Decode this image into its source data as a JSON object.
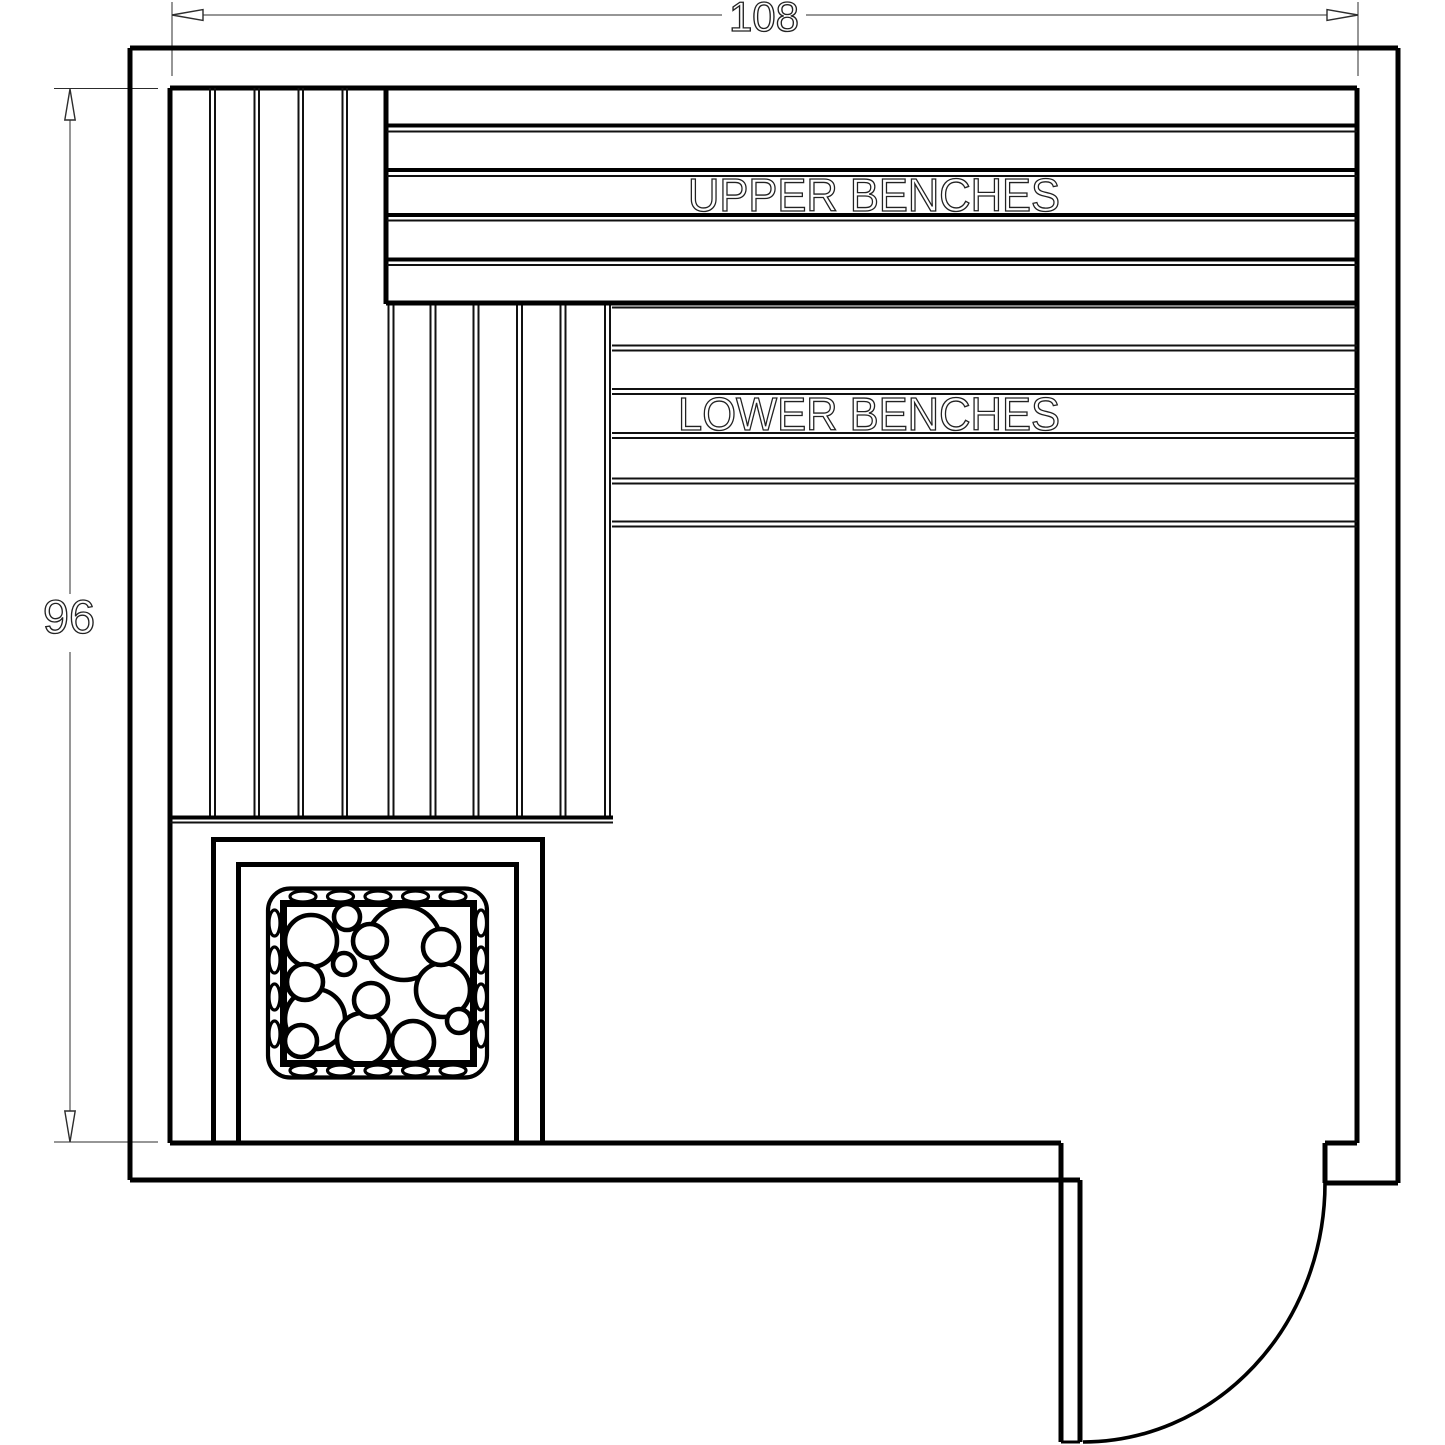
{
  "drawing": {
    "background": "#ffffff",
    "line_color": "#000000",
    "dimensions": {
      "width_value": "108",
      "height_value": "96"
    },
    "labels": {
      "upper_benches": "UPPER BENCHES",
      "lower_benches": "LOWER BENCHES"
    }
  }
}
